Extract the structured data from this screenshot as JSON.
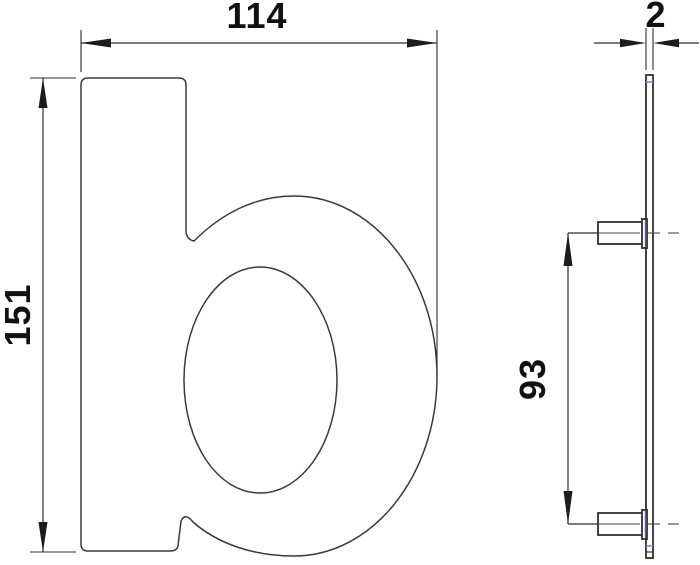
{
  "drawing": {
    "type": "technical-dimension-drawing",
    "glyph": "b",
    "dims": {
      "width": "114",
      "height": "151",
      "thickness": "2",
      "stud_spacing": "93"
    },
    "colors": {
      "background": "#ffffff",
      "outline": "#3a3a3a",
      "dimension_lines": "#2e2e2e",
      "text": "#111111",
      "accent_blue": "#8585bb"
    }
  }
}
